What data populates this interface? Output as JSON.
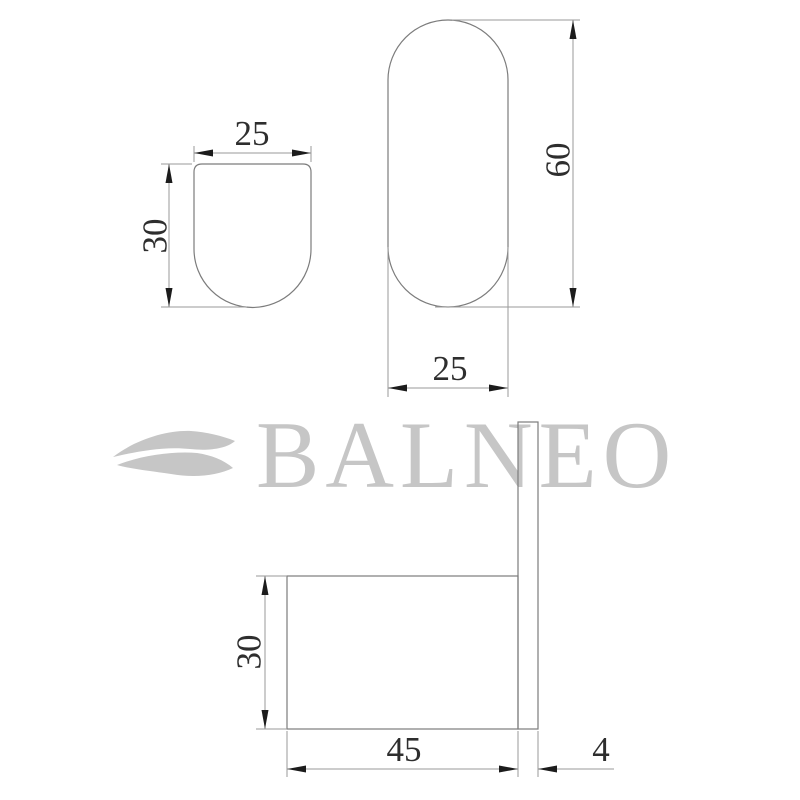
{
  "brand": {
    "name": "BALNEO"
  },
  "drawing": {
    "front_view": {
      "width_label": "25",
      "height_label": "30"
    },
    "profile_view": {
      "height_label": "60",
      "width_label": "25"
    },
    "side_view": {
      "height_label": "30",
      "length_label": "45",
      "thickness_label": "4"
    }
  },
  "colors": {
    "logo_gray": "#c6c6c6",
    "outline_gray": "#7c7c7c",
    "dimension_gray": "#9a9a9a",
    "arrow_black": "#1c1c1c",
    "dimension_text": "#2e2e2e"
  }
}
